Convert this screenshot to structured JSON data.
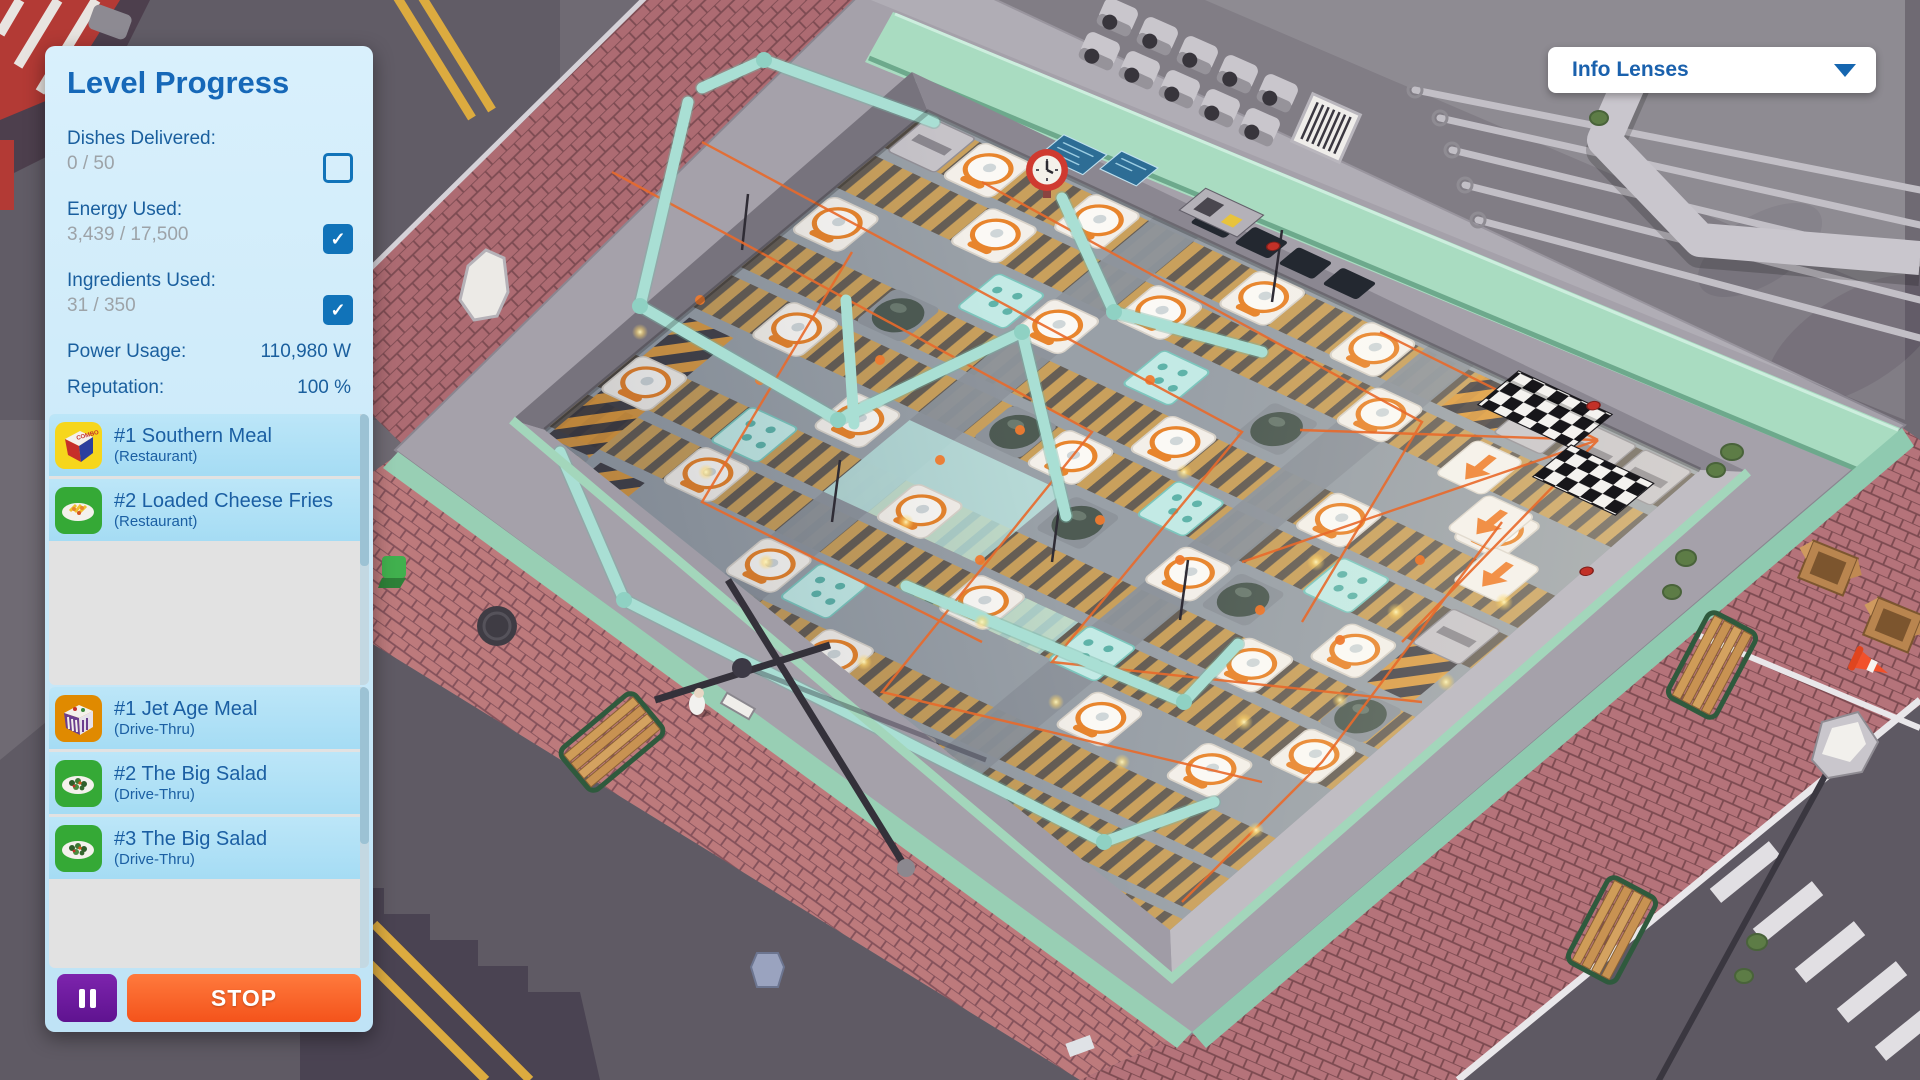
{
  "panel": {
    "title": "Level Progress",
    "stats": [
      {
        "label": "Dishes Delivered:",
        "value": "0 / 50",
        "checked": false
      },
      {
        "label": "Energy Used:",
        "value": "3,439 / 17,500",
        "checked": true
      },
      {
        "label": "Ingredients Used:",
        "value": "31 / 350",
        "checked": true
      }
    ],
    "meters": [
      {
        "label": "Power Usage:",
        "value": "110,980 W"
      },
      {
        "label": "Reputation:",
        "value": "100 %"
      }
    ],
    "restaurant_orders": [
      {
        "name": "#1 Southern Meal",
        "venue": "(Restaurant)",
        "icon": "combo-meal-icon"
      },
      {
        "name": "#2 Loaded Cheese Fries",
        "venue": "(Restaurant)",
        "icon": "fries-plate-icon"
      }
    ],
    "drive_thru_orders": [
      {
        "name": "#1 Jet Age Meal",
        "venue": "(Drive-Thru)",
        "icon": "jet-age-box-icon"
      },
      {
        "name": "#2 The Big Salad",
        "venue": "(Drive-Thru)",
        "icon": "salad-plate-icon"
      },
      {
        "name": "#3 The Big Salad",
        "venue": "(Drive-Thru)",
        "icon": "salad-plate-icon"
      }
    ],
    "controls": {
      "stop_label": "STOP"
    }
  },
  "toolbar": {
    "info_lenses_label": "Info Lenses"
  },
  "icons": {
    "checkmark": "✓",
    "caret": "▼",
    "combo_text": "COMBO"
  },
  "colors": {
    "accent_blue": "#1a69b5",
    "checkbox_blue": "#1173b9",
    "stop_orange": "#f4531b",
    "pause_purple": "#6d1c9c",
    "row_blue": "#ade0f5",
    "mint_wall": "#a9dcc1",
    "brick": "#b5737a",
    "belt_tan": "#c9a05c",
    "pipe_teal": "#a9dfd4",
    "wire_orange": "#e96a2b"
  }
}
